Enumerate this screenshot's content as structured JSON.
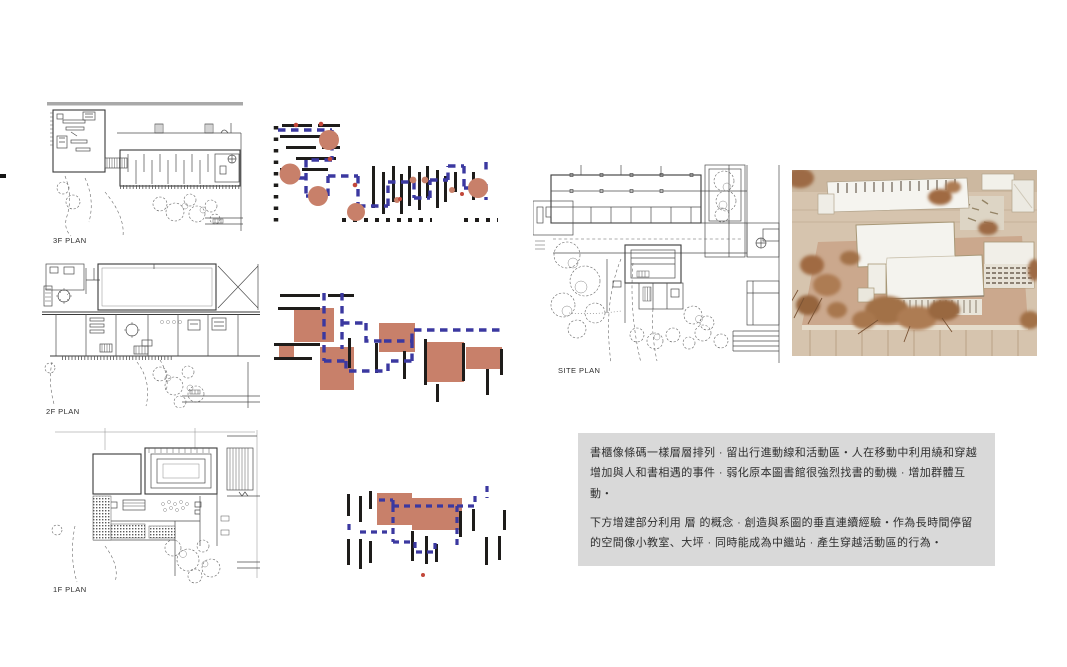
{
  "labels": {
    "plan_3f": "3F PLAN",
    "plan_2f": "2F PLAN",
    "plan_1f": "1F PLAN",
    "site_plan": "SITE PLAN"
  },
  "text_panel": {
    "paragraph_1": "書櫃像條碼一樣層層排列 · 留出行進動線和活動區・人在移動中利用繞和穿越增加與人和書相遇的事件 · 弱化原本圖書館很強烈找書的動機 · 增加群體互動・",
    "paragraph_2": "下方增建部分利用 層 的概念 · 創造與系圖的垂直連續經驗・作為長時間停留的空間像小教室、大坪 · 同時能成為中繼站 · 產生穿越活動區的行為・"
  },
  "colors": {
    "activity_salmon": "#C8806A",
    "circulation_navy": "#3B38A0",
    "shelf_black": "#1E1C1A",
    "panel_background": "#D9D9D9"
  }
}
